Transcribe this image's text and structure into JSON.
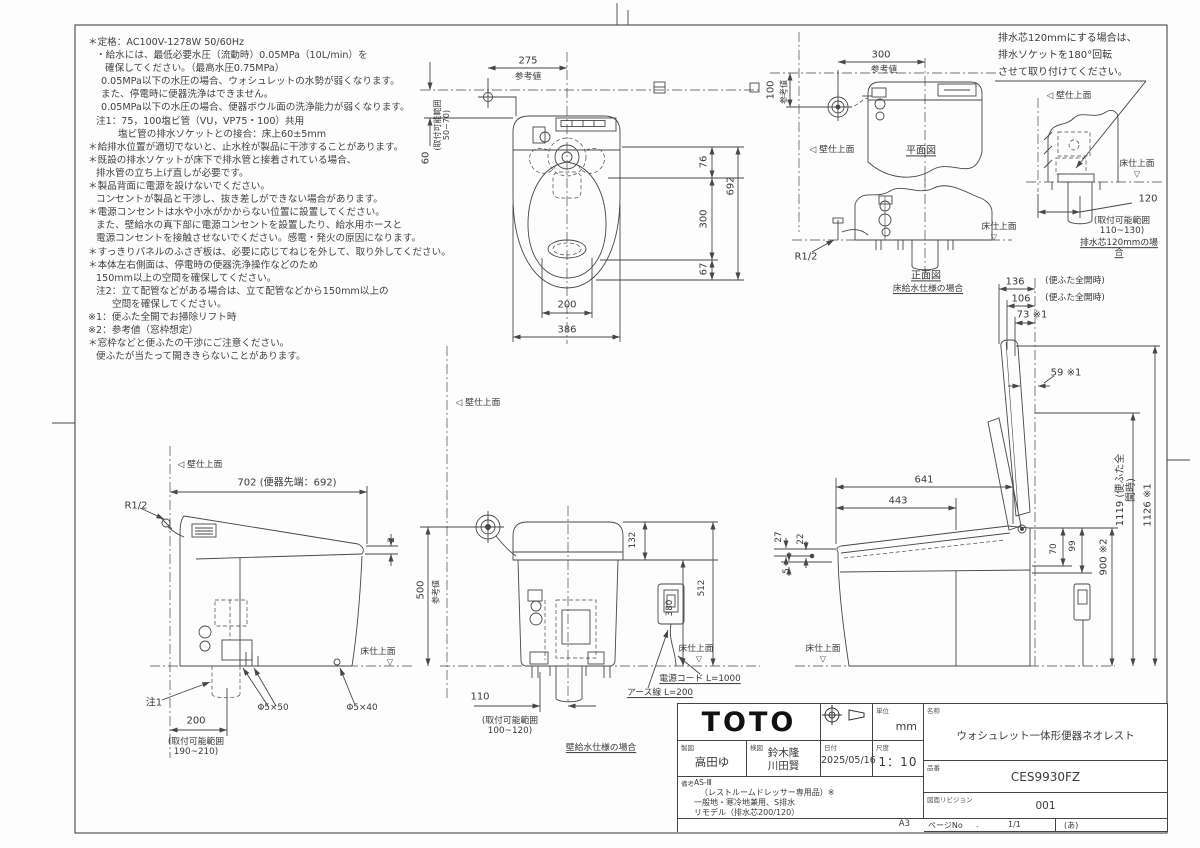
{
  "notes": {
    "lines": [
      "＊定格：AC100V-1278W 50/60Hz",
      "・給水には、最低必要水圧（流動時）0.05MPa（10L/min）を",
      "確保してください。（最高水圧0.75MPa）",
      "0.05MPa以下の水圧の場合、ウォシュレットの水勢が弱くなります。",
      "また、停電時に便器洗浄はできません。",
      "0.05MPa以下の水圧の場合、便器ボウル面の洗浄能力が弱くなります。",
      "注1：75，100塩ビ管（VU，VP75・100）共用",
      "塩ビ管の排水ソケットとの接合：床上60±5mm",
      "＊給排水位置が適切でないと、止水栓が製品に干渉することがあります。",
      "＊既設の排水ソケットが床下で排水管と接着されている場合、",
      "排水管の立ち上げ直しが必要です。",
      "＊製品背面に電源を設けないでください。",
      "コンセントが製品と干渉し、抜き差しができない場合があります。",
      "＊電源コンセントは水や小水がかからない位置に設置してください。",
      "また、壁給水の真下部に電源コンセントを設置したり、給水用ホースと",
      "電源コンセントを接触させないでください。感電・発火の原因になります。",
      "＊すっきりパネルのふさぎ板は、必要に応じてねじを外して、取り外してください。",
      "＊本体左右側面は、停電時の便器洗浄操作などのため",
      "150mm以上の空間を確保してください。",
      "注2：立て配管などがある場合は、立て配管などから150mm以上の",
      "空間を確保してください。",
      "※1：便ふた全開でお掃除リフト時",
      "※2：参考値（窓枠想定）",
      "＊窓枠などと便ふたの干渉にご注意ください。",
      "便ふたが当たって開ききらないことがあります。"
    ]
  },
  "symbols": {
    "wall_marker": "◁",
    "floor_marker": "▽"
  },
  "top_view": {
    "d275": "275",
    "ref": "参考値",
    "d60": "60",
    "range60": "(取付可能範囲\n50~70)",
    "d76": "76",
    "d300": "300",
    "d67": "67",
    "d692": "692",
    "d200": "200",
    "d386": "386"
  },
  "small_plan": {
    "d300": "300",
    "ref": "参考値",
    "d100": "100",
    "ref2": "参考値",
    "wall": "◁ 壁仕上面",
    "title": "平面図"
  },
  "front_view": {
    "r12": "R1/2",
    "floor": "床仕上面",
    "title": "正面図",
    "subtitle": "床給水仕様の場合"
  },
  "drain120": {
    "note1": "排水芯120mmにする場合は、",
    "note2": "排水ソケットを180°回転",
    "note3": "させて取り付けてください。",
    "wall": "◁ 壁仕上面",
    "floor": "床仕上面",
    "d120": "120",
    "range": "(取付可能範囲\n110~130)",
    "caption": "排水芯120mmの場合"
  },
  "open_view": {
    "d136": "136",
    "d136_note": "(便ふた全開時)",
    "d106": "106",
    "d106_note": "(便ふた全開時)",
    "d73": "73 ※1",
    "d59": "59 ※1",
    "d641": "641",
    "d443": "443",
    "d27": "27",
    "d22": "22",
    "d5": "5",
    "d70": "70",
    "d99": "99",
    "d900": "900 ※2",
    "d1119": "1119 (便ふた全開時)",
    "d1126": "1126 ※1",
    "floor": "床仕上面"
  },
  "side_view": {
    "wall": "◁ 壁仕上面",
    "d702": "702 (便器先端：692)",
    "r12": "R1/2",
    "d2": "2",
    "note1": "注1",
    "d200": "200",
    "range": "(取付可能範囲\n190~210)",
    "bolt50": "Φ5×50",
    "bolt40": "Φ5×40",
    "floor": "床仕上面"
  },
  "rear_view": {
    "wall": "◁ 壁仕上面",
    "d500": "500",
    "ref": "参考値",
    "d132": "132",
    "d380": "380",
    "d512": "512",
    "floor": "床仕上面",
    "cord": "電源コード L=1000",
    "earth": "アース線 L=200",
    "d110": "110",
    "range": "(取付可能範囲\n100~120)",
    "caption": "壁給水仕様の場合"
  },
  "title_block": {
    "logo": "TOTO",
    "unit_label": "単位",
    "unit": "mm",
    "drafter_label": "製図",
    "drafter": "高田ゆ",
    "checker_label": "検図",
    "checker1": "鈴木隆",
    "checker2": "川田賢",
    "date_label": "日付",
    "date": "2025/05/16",
    "scale_label": "尺度",
    "scale": "1：10",
    "remarks_label": "備考",
    "remarks": [
      "AS-Ⅲ",
      "（レストルームドレッサー専用品）※",
      "一般地・寒冷地兼用、S排水",
      "リモデル（排水芯200/120）"
    ],
    "name_label": "名称",
    "name": "ウォシュレット一体形便器ネオレスト",
    "number_label": "品番",
    "number": "CES9930FZ",
    "revision_label": "図面リビジョン",
    "revision": "001",
    "sheet_size": "A3",
    "page_label": "ページNo",
    "page_dot": ".",
    "page": "1/1",
    "page_note": "(あ)"
  }
}
